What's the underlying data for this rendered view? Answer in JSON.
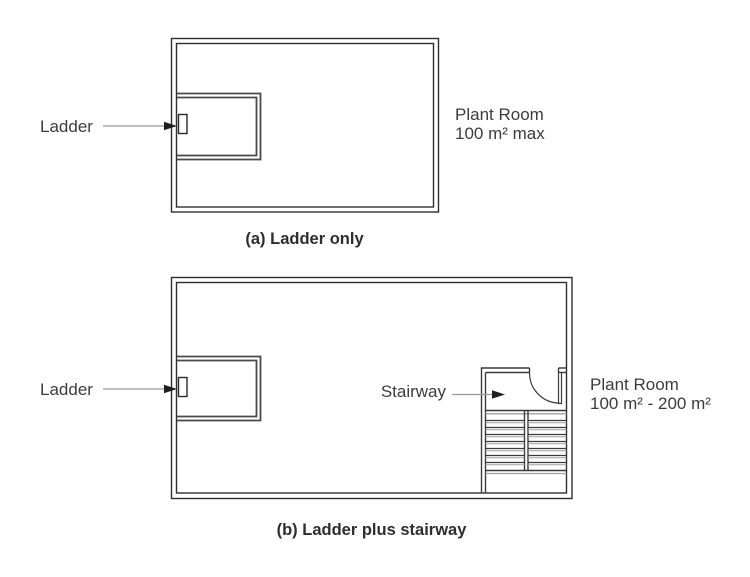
{
  "figure_a": {
    "caption": "(a) Ladder only",
    "ladder_label": "Ladder",
    "room_label_line1": "Plant Room",
    "room_label_line2": "100 m² max"
  },
  "figure_b": {
    "caption": "(b) Ladder plus stairway",
    "ladder_label": "Ladder",
    "stairway_label": "Stairway",
    "room_label_line1": "Plant Room",
    "room_label_line2": "100 m² - 200 m²"
  },
  "colors": {
    "wall_line": "#2f2f2f",
    "enclosure_line": "#4a4a4a",
    "leader_line": "#9a9a9a",
    "arrowhead": "#1f1f1f",
    "tread_shadow": "#a0a0a0",
    "text": "#3c3c3c"
  }
}
